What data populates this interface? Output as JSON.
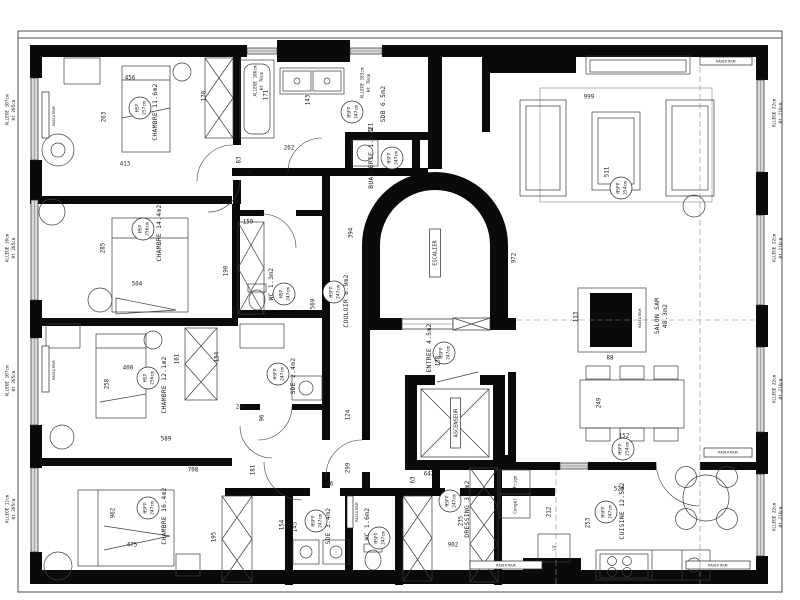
{
  "drawing": {
    "rooms": [
      {
        "name": "CHAMBRE 11.6m2",
        "h1": "HSP",
        "h2": "257cm"
      },
      {
        "name": "CHAMBRE 14.4m2",
        "h1": "HSP",
        "h2": "256cm"
      },
      {
        "name": "CHAMBRE 12.1m2",
        "h1": "HSP",
        "h2": "256cm"
      },
      {
        "name": "CHAMBRE 16.4m2",
        "h1": "HSFP",
        "h2": "247cm"
      },
      {
        "name": "SDB 6.5m2",
        "h1": "HSFP",
        "h2": "247cm"
      },
      {
        "name": "BUANDERIE 1.8m2",
        "h1": "HSFP",
        "h2": "247cm"
      },
      {
        "name": "WC 1.3m2",
        "h1": "HSP",
        "h2": "247cm"
      },
      {
        "name": "SDE 2.4m2",
        "h1": "HSFP",
        "h2": "247cm"
      },
      {
        "name": "COULOIR 8.9m2",
        "h1": "HSFP",
        "h2": "247cm"
      },
      {
        "name": "ENTREE 4.5m2",
        "h1": "HSFP",
        "h2": "247cm"
      },
      {
        "name": "ESCALIER"
      },
      {
        "name": "ASCENSEUR"
      },
      {
        "name": "SDE 3.4m2",
        "h1": "HSFP",
        "h2": "247cm"
      },
      {
        "name": "WC 1.6m2",
        "h1": "HSFP",
        "h2": "247cm"
      },
      {
        "name": "DRESSING 3.9m2",
        "h1": "HSFP",
        "h2": "247cm"
      },
      {
        "name": "CUISINE 12.5m2",
        "h1": "HSFP",
        "h2": "247cm"
      },
      {
        "name": "SALON SAM",
        "name2": "48.3m2",
        "h1": "HSFP",
        "h2": "254cm"
      }
    ],
    "windows": {
      "left": [
        {
          "t": "ALLEGE 107cm",
          "b": "Ht 205cm"
        },
        {
          "t": "ALLEGE 10cm",
          "b": "Ht 205cm"
        },
        {
          "t": "ALLEGE 107cm",
          "b": "Ht 205cm"
        },
        {
          "t": "ALLEGE 11cm",
          "b": "Ht 205cm"
        }
      ],
      "right": [
        {
          "t": "ALLEGE 22cm",
          "b": "Ht 216cm"
        },
        {
          "t": "ALLEGE 22cm",
          "b": "Ht 216cm"
        },
        {
          "t": "ALLEGE 22cm",
          "b": "Ht 216cm"
        },
        {
          "t": "ALLEGE 22cm",
          "b": "Ht 216cm"
        }
      ],
      "top": [
        {
          "t": "ALLEGE 186cm",
          "b": "Ht 70cm"
        },
        {
          "t": "ALLEGE 183cm",
          "b": "Ht 70cm"
        }
      ]
    },
    "equipment": {
      "radiateur": "RADIATEUR",
      "frigo": "Frigo",
      "congel": "Congel",
      "lv": "LV"
    },
    "dims": [
      "456",
      "263",
      "413",
      "178",
      "285",
      "504",
      "190",
      "400",
      "258",
      "161",
      "589",
      "154",
      "249",
      "96",
      "708",
      "181",
      "962",
      "475",
      "195",
      "171",
      "143",
      "321",
      "262",
      "83",
      "178",
      "159",
      "394",
      "972",
      "138",
      "569",
      "124",
      "999",
      "511",
      "113",
      "88",
      "249",
      "152",
      "446",
      "299",
      "642",
      "63",
      "212",
      "253",
      "523",
      "235",
      "902",
      "154",
      "145"
    ]
  }
}
